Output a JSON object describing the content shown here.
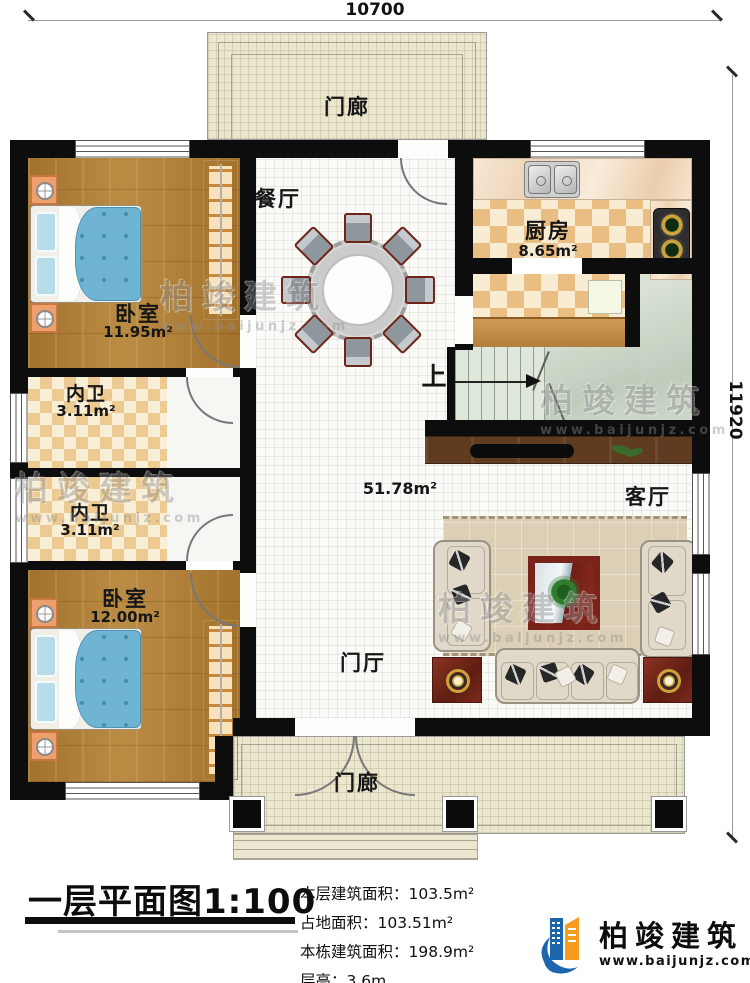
{
  "dimensions": {
    "top": "10700",
    "right": "11920"
  },
  "rooms": {
    "porch_top": {
      "label": "门廊"
    },
    "porch_bottom": {
      "label": "门廊"
    },
    "dining": {
      "label": "餐厅"
    },
    "kitchen": {
      "label": "厨房",
      "area": "8.65m²"
    },
    "bedroom1": {
      "label": "卧室",
      "area": "11.95m²"
    },
    "bath1": {
      "label": "内卫",
      "area": "3.11m²"
    },
    "bath2": {
      "label": "内卫",
      "area": "3.11m²"
    },
    "bedroom2": {
      "label": "卧室",
      "area": "12.00m²"
    },
    "living": {
      "label": "客厅"
    },
    "foyer": {
      "label": "门厅"
    },
    "stairs": {
      "label": "上"
    },
    "open_area": {
      "area": "51.78m²"
    }
  },
  "footer": {
    "title": "一层平面图1:100",
    "stats": [
      "本层建筑面积：103.5m²",
      "占地面积：103.51m²",
      "本栋建筑面积：198.9m²",
      "层高：3.6m"
    ]
  },
  "logo": {
    "name": "柏竣建筑",
    "url": "www.baijunjz.com"
  },
  "watermark": {
    "text": "柏竣建筑",
    "url": "www.baijunjz.com"
  },
  "colors": {
    "accent_blue": "#1b66ad",
    "accent_orange": "#f59b1f",
    "wall": "#0d0d0d"
  }
}
